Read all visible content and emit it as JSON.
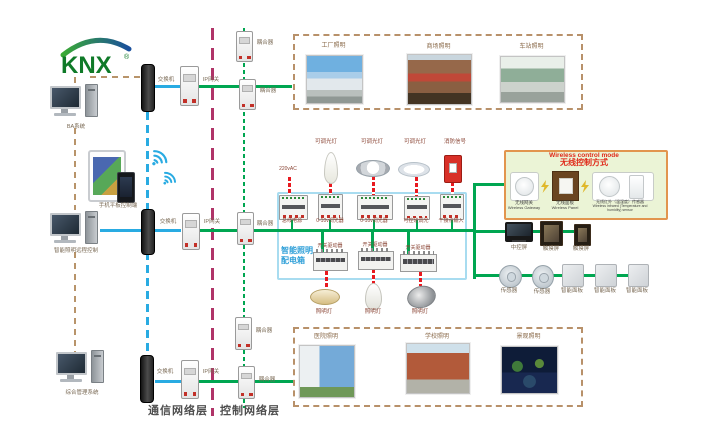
{
  "logo": {
    "text": "KNX",
    "reg": "®"
  },
  "left": {
    "ba": "BA系统",
    "mobile": "手机平板控制端",
    "remote": "智能照明远程控制",
    "mgmt": "综合管理系统"
  },
  "net": {
    "switch": "交换机",
    "gateway": "IP网关",
    "coupler": "耦合器",
    "comm_layer": "通信网络层",
    "ctrl_layer": "控制网络层"
  },
  "photos": {
    "factory": "工厂照明",
    "mall": "商场照明",
    "station": "车站照明",
    "hospital": "医院照明",
    "school": "学校照明",
    "landscape": "景观照明"
  },
  "cabinet": {
    "name_line1": "智能照明",
    "name_line2": "配电箱",
    "ac_input": "220vAC",
    "bus_power": "总线电源",
    "dimmer_0_10v": "0-10v调光器",
    "scr_dimmer": "可控硅调光",
    "dry_contact": "干接点输入",
    "switch_driver": "开关驱动器",
    "dimmable_lamp": "可调光灯",
    "fire_signal": "消防信号",
    "lamp": "照明灯"
  },
  "wireless": {
    "title_en": "Wireless control mode",
    "title_cn": "无线控制方式",
    "gateway_cn": "无线网关",
    "gateway_en": "Wireless Gateway",
    "panel_cn": "无线面板",
    "panel_en": "Wireless Panel",
    "sensor_cn": "无线红外（温湿度）传感器",
    "sensor_en": "Wireless infrared (Temperature and humidity) sensor"
  },
  "right": {
    "central_screen": "中控屏",
    "touch_screen": "触摸屏",
    "sensor": "传感器",
    "smart_panel": "智能面板"
  },
  "colors": {
    "green": "#00a651",
    "blue": "#29abe2",
    "red": "#e8191f",
    "magenta": "#b03468",
    "tan": "#b8946a",
    "cabinet_blue": "#2e9fd8",
    "wireless_border": "#e2954e",
    "wireless_bg": "#ebf4d6",
    "title_red": "#e02818"
  }
}
